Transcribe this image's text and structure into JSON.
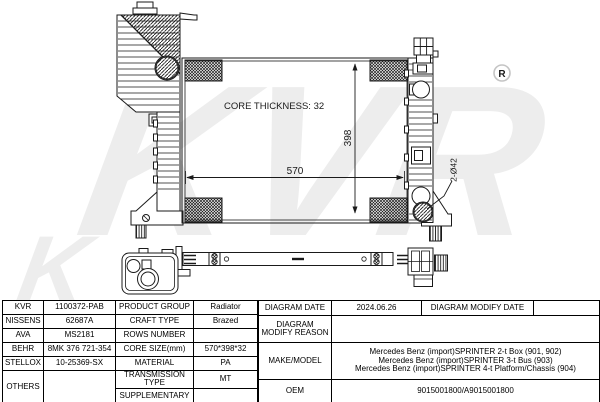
{
  "drawing": {
    "watermark": "KVR",
    "watermark_partial": "K",
    "registered_mark": "R",
    "core_thickness_label": "CORE THICKNESS: 32",
    "width_dim": "570",
    "height_dim": "398",
    "port_dim": "2-Ø42"
  },
  "table": {
    "left": {
      "rows": [
        {
          "brand": "KVR",
          "code": "1100372-PAB",
          "label": "PRODUCT GROUP",
          "value": "Radiator"
        },
        {
          "brand": "NISSENS",
          "code": "62687A",
          "label": "CRAFT TYPE",
          "value": "Brazed"
        },
        {
          "brand": "AVA",
          "code": "MS2181",
          "label": "ROWS NUMBER",
          "value": ""
        },
        {
          "brand": "BEHR",
          "code": "8MK 376 721-354",
          "label": "CORE SIZE(mm)",
          "value": "570*398*32"
        },
        {
          "brand": "STELLOX",
          "code": "10-25369-SX",
          "label": "MATERIAL",
          "value": "PA"
        },
        {
          "brand": "OTHERS",
          "code": "",
          "label": "TRANSMISSION TYPE",
          "value": "MT"
        },
        {
          "label": "SUPPLEMENTARY",
          "value": ""
        }
      ]
    },
    "right": {
      "diagram_date_label": "DIAGRAM DATE",
      "diagram_date": "2024.06.26",
      "diagram_modify_date_label": "DIAGRAM MODIFY DATE",
      "diagram_modify_date": "",
      "diagram_modify_reason_label": "DIAGRAM MODIFY REASON",
      "diagram_modify_reason": "",
      "make_model_label": "MAKE/MODEL",
      "make_model_lines": [
        "Mercedes Benz (import)SPRINTER 2-t Box (901, 902)",
        "Mercedes Benz (import)SPRINTER 3-t Bus (903)",
        "Mercedes Benz (import)SPRINTER 4-t Platform/Chassis (904)"
      ],
      "oem_label": "OEM",
      "oem": "9015001800/A9015001800"
    }
  }
}
